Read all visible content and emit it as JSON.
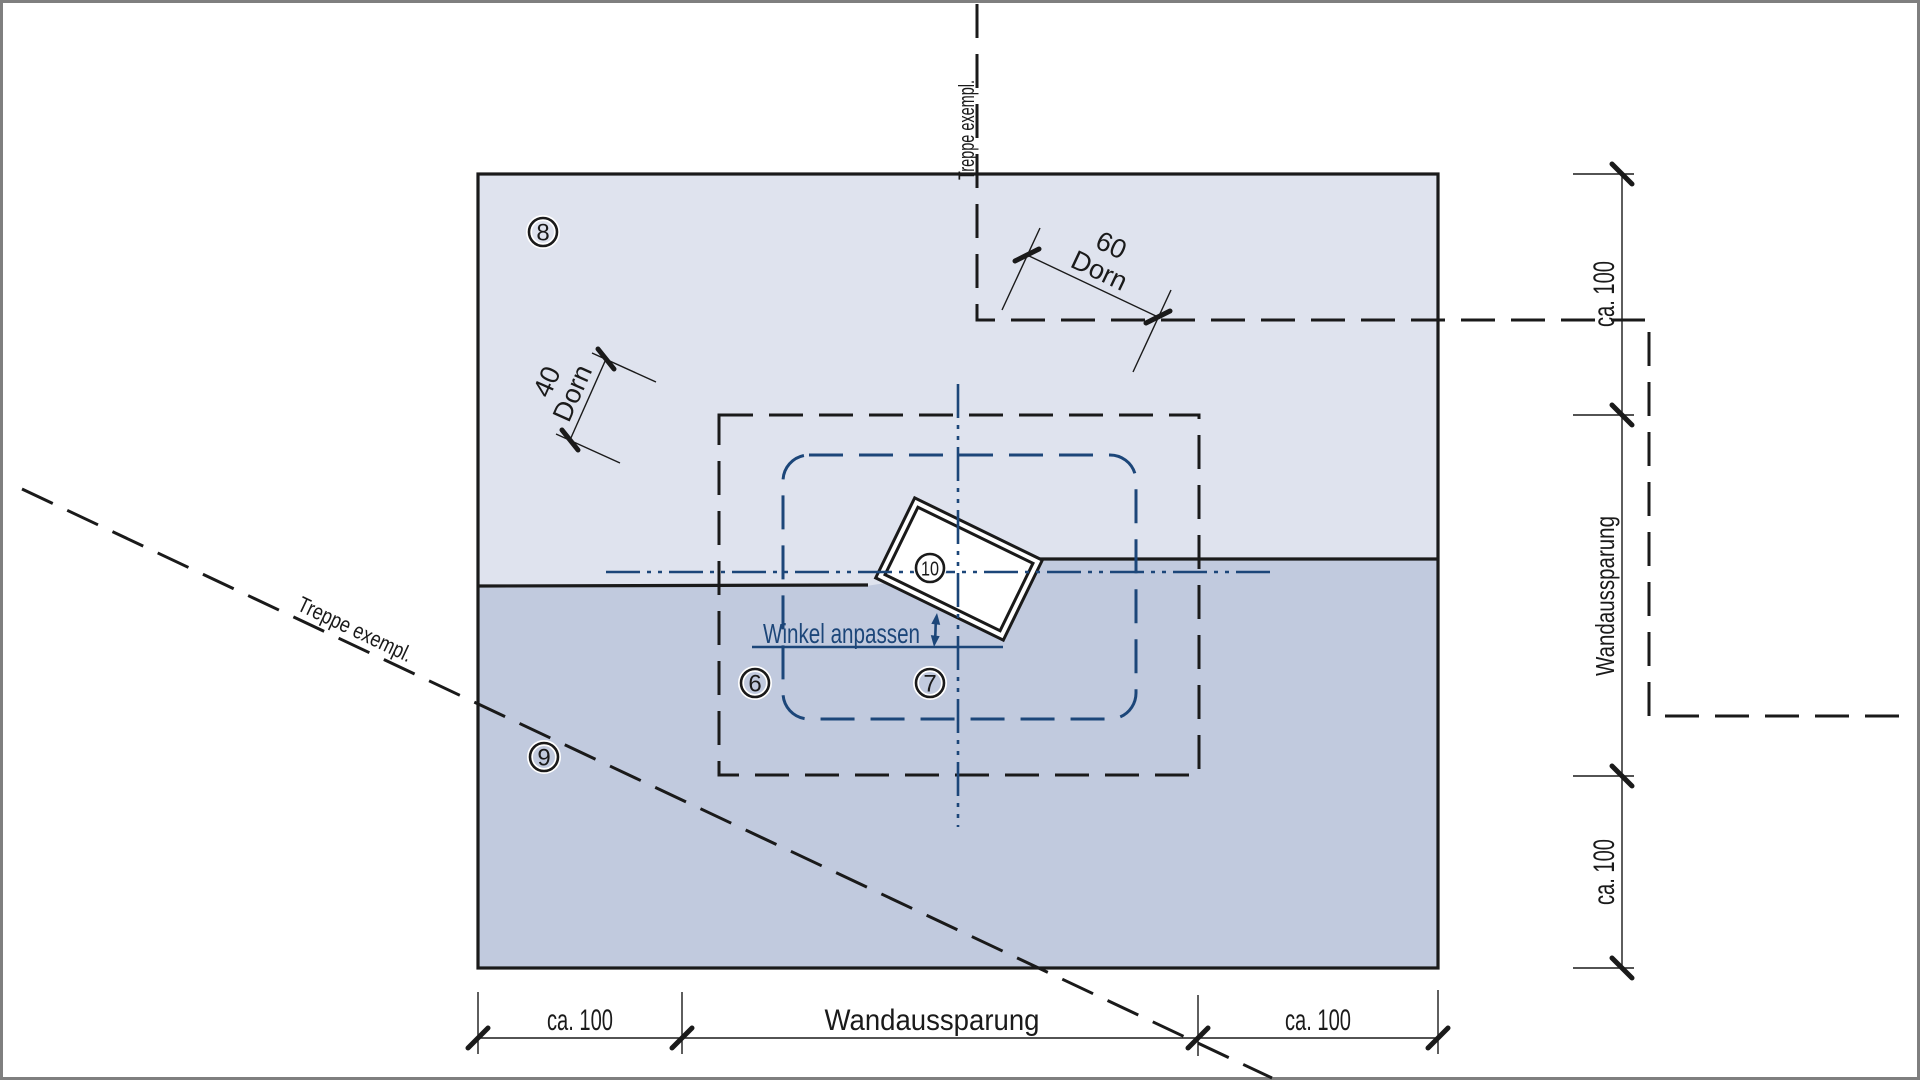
{
  "drawing": {
    "colors": {
      "light_fill": "#dfe3ee",
      "dark_fill": "#c1cade",
      "line_black": "#1a1a1a",
      "line_navy": "#1c4679",
      "frame_gray": "#7f7f7f",
      "white": "#ffffff"
    },
    "markers": {
      "m6": "6",
      "m7": "7",
      "m8": "8",
      "m9": "9",
      "m10": "10"
    },
    "notes": {
      "winkel": "Winkel anpassen",
      "treppe_top": "Treppe exempl.",
      "treppe_diag": "Treppe exempl."
    },
    "dims": {
      "bottom_left": "ca. 100",
      "bottom_mid": "Wandaussparung",
      "bottom_right": "ca. 100",
      "right_top": "ca. 100",
      "right_mid": "Wandaussparung",
      "right_bottom": "ca. 100",
      "dorn60_value": "60",
      "dorn60_label": "Dorn",
      "dorn40_value": "40",
      "dorn40_label": "Dorn"
    }
  }
}
